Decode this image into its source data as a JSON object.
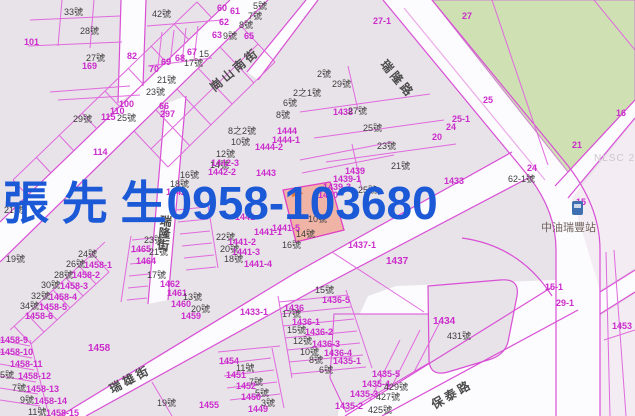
{
  "map": {
    "overlay": {
      "text": "張 先 生0958-103680",
      "color": "#1b59d6"
    },
    "nlsc_watermark": "NLSC 2",
    "gas_station": {
      "label": "中油瑞豐站"
    },
    "streets": [
      {
        "name": "崗山南街",
        "x": 206,
        "y": 82,
        "rot": -40,
        "v": false
      },
      {
        "name": "瑞隆路",
        "x": 390,
        "y": 56,
        "rot": 50,
        "v": false
      },
      {
        "name": "瑞隆街",
        "x": 158,
        "y": 214,
        "rot": 6,
        "v": true
      },
      {
        "name": "瑞雄街",
        "x": 106,
        "y": 382,
        "rot": -28,
        "v": false
      },
      {
        "name": "保泰路",
        "x": 428,
        "y": 398,
        "rot": -30,
        "v": false
      }
    ],
    "colors": {
      "parcel_line": "#d94fd6",
      "parcel_fill": "#e8e3e8",
      "road_fill": "#fcfbfd",
      "green_area": "#cfe0b3",
      "pink_area": "#f3ecf2",
      "highlight_parcel": "#efb4a6",
      "lot_number": "#cb2ccc",
      "house_number": "#3d3d3d",
      "overlay_blue": "#1b59d6",
      "marker_orange": "#e0762e"
    },
    "labels": [
      {
        "t": "33號",
        "x": 64,
        "y": 8,
        "c": "k"
      },
      {
        "t": "42號",
        "x": 152,
        "y": 10,
        "c": "k"
      },
      {
        "t": "28號",
        "x": 80,
        "y": 27,
        "c": "k"
      },
      {
        "t": "27號",
        "x": 86,
        "y": 54,
        "c": "k"
      },
      {
        "t": "169",
        "x": 82,
        "y": 62,
        "c": "m"
      },
      {
        "t": "101",
        "x": 24,
        "y": 38,
        "c": "m"
      },
      {
        "t": "82",
        "x": 127,
        "y": 52,
        "c": "m"
      },
      {
        "t": "70",
        "x": 149,
        "y": 65,
        "c": "m"
      },
      {
        "t": "69",
        "x": 161,
        "y": 58,
        "c": "m"
      },
      {
        "t": "68",
        "x": 175,
        "y": 54,
        "c": "m"
      },
      {
        "t": "67",
        "x": 187,
        "y": 48,
        "c": "m"
      },
      {
        "t": "15",
        "x": 199,
        "y": 50,
        "c": "k"
      },
      {
        "t": "17號",
        "x": 184,
        "y": 59,
        "c": "k"
      },
      {
        "t": "21號",
        "x": 157,
        "y": 76,
        "c": "k"
      },
      {
        "t": "23號",
        "x": 146,
        "y": 88,
        "c": "k"
      },
      {
        "t": "66",
        "x": 159,
        "y": 102,
        "c": "m"
      },
      {
        "t": "297",
        "x": 160,
        "y": 110,
        "c": "m"
      },
      {
        "t": "100",
        "x": 119,
        "y": 100,
        "c": "m"
      },
      {
        "t": "110",
        "x": 110,
        "y": 107,
        "c": "m"
      },
      {
        "t": "115",
        "x": 101,
        "y": 113,
        "c": "m"
      },
      {
        "t": "25號",
        "x": 117,
        "y": 114,
        "c": "k"
      },
      {
        "t": "29號",
        "x": 73,
        "y": 115,
        "c": "k"
      },
      {
        "t": "114",
        "x": 93,
        "y": 148,
        "c": "m"
      },
      {
        "t": "21號",
        "x": 4,
        "y": 206,
        "c": "k"
      },
      {
        "t": "19號",
        "x": 6,
        "y": 255,
        "c": "k"
      },
      {
        "t": "5號",
        "x": 253,
        "y": 2,
        "c": "k"
      },
      {
        "t": "61",
        "x": 230,
        "y": 7,
        "c": "m"
      },
      {
        "t": "60",
        "x": 217,
        "y": 4,
        "c": "m"
      },
      {
        "t": "7號",
        "x": 248,
        "y": 12,
        "c": "k"
      },
      {
        "t": "8號",
        "x": 239,
        "y": 21,
        "c": "k"
      },
      {
        "t": "62",
        "x": 219,
        "y": 18,
        "c": "m"
      },
      {
        "t": "63",
        "x": 212,
        "y": 31,
        "c": "m"
      },
      {
        "t": "9號",
        "x": 223,
        "y": 32,
        "c": "k"
      },
      {
        "t": "65",
        "x": 244,
        "y": 32,
        "c": "m"
      },
      {
        "t": "8之2號",
        "x": 228,
        "y": 127,
        "c": "k"
      },
      {
        "t": "10號",
        "x": 231,
        "y": 138,
        "c": "k"
      },
      {
        "t": "12號",
        "x": 216,
        "y": 150,
        "c": "k"
      },
      {
        "t": "14號",
        "x": 210,
        "y": 161,
        "c": "k"
      },
      {
        "t": "1444",
        "x": 277,
        "y": 127,
        "c": "m"
      },
      {
        "t": "1444-1",
        "x": 272,
        "y": 136,
        "c": "m"
      },
      {
        "t": "1444-2",
        "x": 255,
        "y": 143,
        "c": "m"
      },
      {
        "t": "1443",
        "x": 256,
        "y": 169,
        "c": "m"
      },
      {
        "t": "1442-3",
        "x": 211,
        "y": 159,
        "c": "m"
      },
      {
        "t": "1442-2",
        "x": 208,
        "y": 168,
        "c": "m"
      },
      {
        "t": "16號",
        "x": 180,
        "y": 171,
        "c": "k"
      },
      {
        "t": "18號",
        "x": 170,
        "y": 180,
        "c": "k"
      },
      {
        "t": "1442",
        "x": 166,
        "y": 188,
        "c": "m"
      },
      {
        "t": "2號",
        "x": 317,
        "y": 70,
        "c": "k"
      },
      {
        "t": "29號",
        "x": 332,
        "y": 80,
        "c": "k"
      },
      {
        "t": "2之1號",
        "x": 293,
        "y": 89,
        "c": "k"
      },
      {
        "t": "6號",
        "x": 283,
        "y": 99,
        "c": "k"
      },
      {
        "t": "8號",
        "x": 276,
        "y": 111,
        "c": "k"
      },
      {
        "t": "1438",
        "x": 333,
        "y": 108,
        "c": "m"
      },
      {
        "t": "27號",
        "x": 348,
        "y": 107,
        "c": "k"
      },
      {
        "t": "25號",
        "x": 363,
        "y": 124,
        "c": "k"
      },
      {
        "t": "23號",
        "x": 377,
        "y": 142,
        "c": "k"
      },
      {
        "t": "21號",
        "x": 391,
        "y": 162,
        "c": "k"
      },
      {
        "t": "27-1",
        "x": 373,
        "y": 17,
        "c": "m"
      },
      {
        "t": "27",
        "x": 462,
        "y": 12,
        "c": "m"
      },
      {
        "t": "25",
        "x": 483,
        "y": 96,
        "c": "m"
      },
      {
        "t": "25-1",
        "x": 452,
        "y": 115,
        "c": "m"
      },
      {
        "t": "24",
        "x": 446,
        "y": 123,
        "c": "m"
      },
      {
        "t": "20",
        "x": 432,
        "y": 133,
        "c": "m"
      },
      {
        "t": "16",
        "x": 616,
        "y": 109,
        "c": "m"
      },
      {
        "t": "21",
        "x": 572,
        "y": 141,
        "c": "m"
      },
      {
        "t": "24",
        "x": 527,
        "y": 164,
        "c": "m"
      },
      {
        "t": "62-1號",
        "x": 508,
        "y": 175,
        "c": "k"
      },
      {
        "t": "1433",
        "x": 444,
        "y": 177,
        "c": "m"
      },
      {
        "t": "15",
        "x": 576,
        "y": 198,
        "c": "m"
      },
      {
        "t": "15-1",
        "x": 545,
        "y": 283,
        "c": "m"
      },
      {
        "t": "29-1",
        "x": 556,
        "y": 299,
        "c": "m"
      },
      {
        "t": "1453",
        "x": 612,
        "y": 322,
        "c": "m"
      },
      {
        "t": "1439",
        "x": 345,
        "y": 167,
        "c": "m"
      },
      {
        "t": "1439-1",
        "x": 333,
        "y": 175,
        "c": "m"
      },
      {
        "t": "1439-3",
        "x": 323,
        "y": 183,
        "c": "m"
      },
      {
        "t": "1440",
        "x": 318,
        "y": 191,
        "c": "m"
      },
      {
        "t": "25號",
        "x": 358,
        "y": 186,
        "c": "k"
      },
      {
        "t": "10號",
        "x": 308,
        "y": 215,
        "c": "k"
      },
      {
        "t": "1441",
        "x": 235,
        "y": 213,
        "c": "m"
      },
      {
        "t": "1441-5",
        "x": 272,
        "y": 224,
        "c": "m"
      },
      {
        "t": "14號",
        "x": 296,
        "y": 230,
        "c": "k"
      },
      {
        "t": "16號",
        "x": 282,
        "y": 241,
        "c": "k"
      },
      {
        "t": "1441-1",
        "x": 254,
        "y": 228,
        "c": "m"
      },
      {
        "t": "22號",
        "x": 216,
        "y": 233,
        "c": "k"
      },
      {
        "t": "1441-2",
        "x": 228,
        "y": 238,
        "c": "m"
      },
      {
        "t": "20號",
        "x": 220,
        "y": 245,
        "c": "k"
      },
      {
        "t": "1441-3",
        "x": 232,
        "y": 248,
        "c": "m"
      },
      {
        "t": "18號",
        "x": 224,
        "y": 255,
        "c": "k"
      },
      {
        "t": "1441-4",
        "x": 244,
        "y": 260,
        "c": "m"
      },
      {
        "t": "23號",
        "x": 144,
        "y": 236,
        "c": "k"
      },
      {
        "t": "1465",
        "x": 131,
        "y": 245,
        "c": "m"
      },
      {
        "t": "21號",
        "x": 149,
        "y": 248,
        "c": "k"
      },
      {
        "t": "1464",
        "x": 136,
        "y": 257,
        "c": "m"
      },
      {
        "t": "17號",
        "x": 147,
        "y": 271,
        "c": "k"
      },
      {
        "t": "1462",
        "x": 160,
        "y": 280,
        "c": "m"
      },
      {
        "t": "1461",
        "x": 167,
        "y": 289,
        "c": "m"
      },
      {
        "t": "13號",
        "x": 183,
        "y": 293,
        "c": "k"
      },
      {
        "t": "1460",
        "x": 171,
        "y": 300,
        "c": "m"
      },
      {
        "t": "20號",
        "x": 191,
        "y": 305,
        "c": "k"
      },
      {
        "t": "1459",
        "x": 181,
        "y": 312,
        "c": "m"
      },
      {
        "t": "24號",
        "x": 78,
        "y": 250,
        "c": "k"
      },
      {
        "t": "26號",
        "x": 66,
        "y": 260,
        "c": "k"
      },
      {
        "t": "1458-1",
        "x": 84,
        "y": 261,
        "c": "m"
      },
      {
        "t": "28號",
        "x": 54,
        "y": 271,
        "c": "k"
      },
      {
        "t": "1458-2",
        "x": 72,
        "y": 271,
        "c": "m"
      },
      {
        "t": "30號",
        "x": 41,
        "y": 281,
        "c": "k"
      },
      {
        "t": "1458-3",
        "x": 60,
        "y": 282,
        "c": "m"
      },
      {
        "t": "32號",
        "x": 31,
        "y": 292,
        "c": "k"
      },
      {
        "t": "1458-4",
        "x": 49,
        "y": 293,
        "c": "m"
      },
      {
        "t": "34號",
        "x": 20,
        "y": 302,
        "c": "k"
      },
      {
        "t": "1458-5",
        "x": 39,
        "y": 303,
        "c": "m"
      },
      {
        "t": "1458-6",
        "x": 25,
        "y": 312,
        "c": "m"
      },
      {
        "t": "1458-9",
        "x": 0,
        "y": 336,
        "c": "m"
      },
      {
        "t": "1458-10",
        "x": 0,
        "y": 348,
        "c": "m"
      },
      {
        "t": "1458-11",
        "x": 10,
        "y": 360,
        "c": "m"
      },
      {
        "t": "5號",
        "x": 0,
        "y": 371,
        "c": "k"
      },
      {
        "t": "1458-12",
        "x": 18,
        "y": 372,
        "c": "m"
      },
      {
        "t": "7號",
        "x": 12,
        "y": 384,
        "c": "k"
      },
      {
        "t": "1458-13",
        "x": 26,
        "y": 385,
        "c": "m"
      },
      {
        "t": "9號",
        "x": 20,
        "y": 396,
        "c": "k"
      },
      {
        "t": "1458-14",
        "x": 34,
        "y": 397,
        "c": "m"
      },
      {
        "t": "11號",
        "x": 28,
        "y": 408,
        "c": "k"
      },
      {
        "t": "1458-15",
        "x": 46,
        "y": 409,
        "c": "m"
      },
      {
        "t": "1458",
        "x": 88,
        "y": 344,
        "c": "m",
        "s": 10
      },
      {
        "t": "19號",
        "x": 157,
        "y": 399,
        "c": "k"
      },
      {
        "t": "1437-1",
        "x": 348,
        "y": 241,
        "c": "m"
      },
      {
        "t": "1437",
        "x": 386,
        "y": 257,
        "c": "m",
        "s": 10
      },
      {
        "t": "1433-1",
        "x": 240,
        "y": 308,
        "c": "m"
      },
      {
        "t": "15號",
        "x": 315,
        "y": 286,
        "c": "k"
      },
      {
        "t": "1436-5",
        "x": 322,
        "y": 296,
        "c": "m"
      },
      {
        "t": "1436",
        "x": 284,
        "y": 304,
        "c": "m"
      },
      {
        "t": "17號",
        "x": 282,
        "y": 310,
        "c": "k"
      },
      {
        "t": "1436-1",
        "x": 292,
        "y": 318,
        "c": "m"
      },
      {
        "t": "15號",
        "x": 287,
        "y": 326,
        "c": "k"
      },
      {
        "t": "1436-2",
        "x": 305,
        "y": 328,
        "c": "m"
      },
      {
        "t": "12號",
        "x": 293,
        "y": 337,
        "c": "k"
      },
      {
        "t": "1436-3",
        "x": 312,
        "y": 340,
        "c": "m"
      },
      {
        "t": "10號",
        "x": 300,
        "y": 348,
        "c": "k"
      },
      {
        "t": "1436-4",
        "x": 324,
        "y": 349,
        "c": "m"
      },
      {
        "t": "8號",
        "x": 309,
        "y": 356,
        "c": "k"
      },
      {
        "t": "1435-1",
        "x": 333,
        "y": 357,
        "c": "m"
      },
      {
        "t": "6號",
        "x": 319,
        "y": 366,
        "c": "k"
      },
      {
        "t": "1454",
        "x": 219,
        "y": 357,
        "c": "m"
      },
      {
        "t": "11號",
        "x": 236,
        "y": 364,
        "c": "k"
      },
      {
        "t": "1451",
        "x": 226,
        "y": 371,
        "c": "m"
      },
      {
        "t": "7號",
        "x": 249,
        "y": 378,
        "c": "k"
      },
      {
        "t": "1452",
        "x": 236,
        "y": 382,
        "c": "m"
      },
      {
        "t": "5號",
        "x": 255,
        "y": 389,
        "c": "k"
      },
      {
        "t": "1450",
        "x": 241,
        "y": 393,
        "c": "m"
      },
      {
        "t": "3號",
        "x": 261,
        "y": 399,
        "c": "k"
      },
      {
        "t": "1449",
        "x": 248,
        "y": 405,
        "c": "m"
      },
      {
        "t": "1455",
        "x": 199,
        "y": 401,
        "c": "m"
      },
      {
        "t": "1435-5",
        "x": 372,
        "y": 370,
        "c": "m"
      },
      {
        "t": "1435-4",
        "x": 362,
        "y": 380,
        "c": "m"
      },
      {
        "t": "429號",
        "x": 384,
        "y": 383,
        "c": "k"
      },
      {
        "t": "1435-3",
        "x": 350,
        "y": 390,
        "c": "m"
      },
      {
        "t": "427號",
        "x": 376,
        "y": 393,
        "c": "k"
      },
      {
        "t": "1435-2",
        "x": 335,
        "y": 402,
        "c": "m"
      },
      {
        "t": "425號",
        "x": 368,
        "y": 406,
        "c": "k"
      },
      {
        "t": "1434",
        "x": 433,
        "y": 317,
        "c": "m",
        "s": 10
      },
      {
        "t": "431號",
        "x": 447,
        "y": 332,
        "c": "k"
      }
    ]
  }
}
